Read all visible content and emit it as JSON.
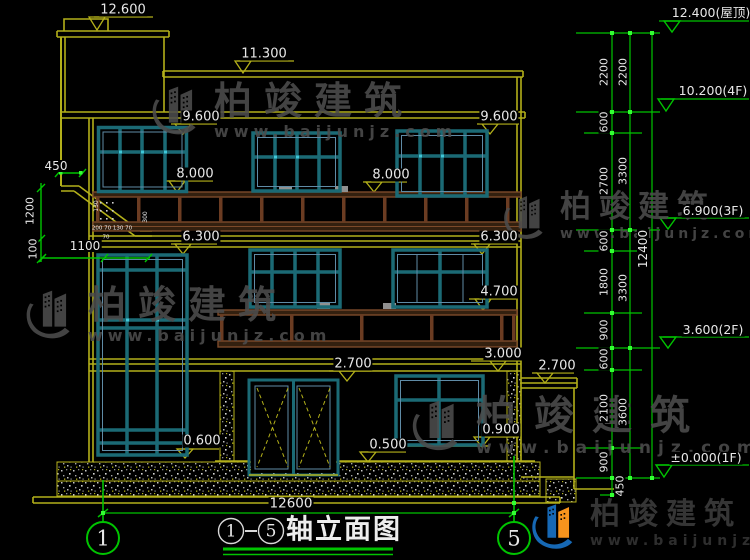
{
  "drawing_title": {
    "bubble_left": "1",
    "bubble_right": "5",
    "separator": "-",
    "text": "轴立面图"
  },
  "bottom_dim": "12600",
  "grid_bubbles": {
    "left": "1",
    "right": "5"
  },
  "face_markers": {
    "t12600": "12.600",
    "t11300": "11.300",
    "t9600_l": "9.600",
    "t9600_r": "9.600",
    "t8000_l": "8.000",
    "t8000_r": "8.000",
    "t6300_l": "6.300",
    "t6300_r": "6.300",
    "t4700": "4.700",
    "t3000": "3.000",
    "t2700_door": "2.700",
    "t2700_side": "2.700",
    "t0900": "0.900",
    "t0500": "0.500",
    "t0600": "0.600"
  },
  "level_markers": {
    "roof": "12.400(屋顶)",
    "f4": "10.200(4F)",
    "f3": "6.900(3F)",
    "f2": "3.600(2F)",
    "f1": "±0.000(1F)"
  },
  "dim_chain_inner": [
    "2200",
    "600",
    "2700",
    "600",
    "1800",
    "900",
    "600",
    "2100",
    "900"
  ],
  "dim_chain_outer": [
    "2200",
    "3300",
    "3300",
    "3600"
  ],
  "dim_base": "450",
  "dim_total": "12400",
  "left_dims": {
    "offset": "450",
    "balcony_height": "1200",
    "step": "100",
    "width": "1100"
  },
  "micro_dims": {
    "a": "130",
    "b": "300",
    "c": "200 70 130 70",
    "d": "70"
  },
  "watermark": {
    "brand": "柏竣建筑",
    "site": "www.baijunjz.com"
  }
}
